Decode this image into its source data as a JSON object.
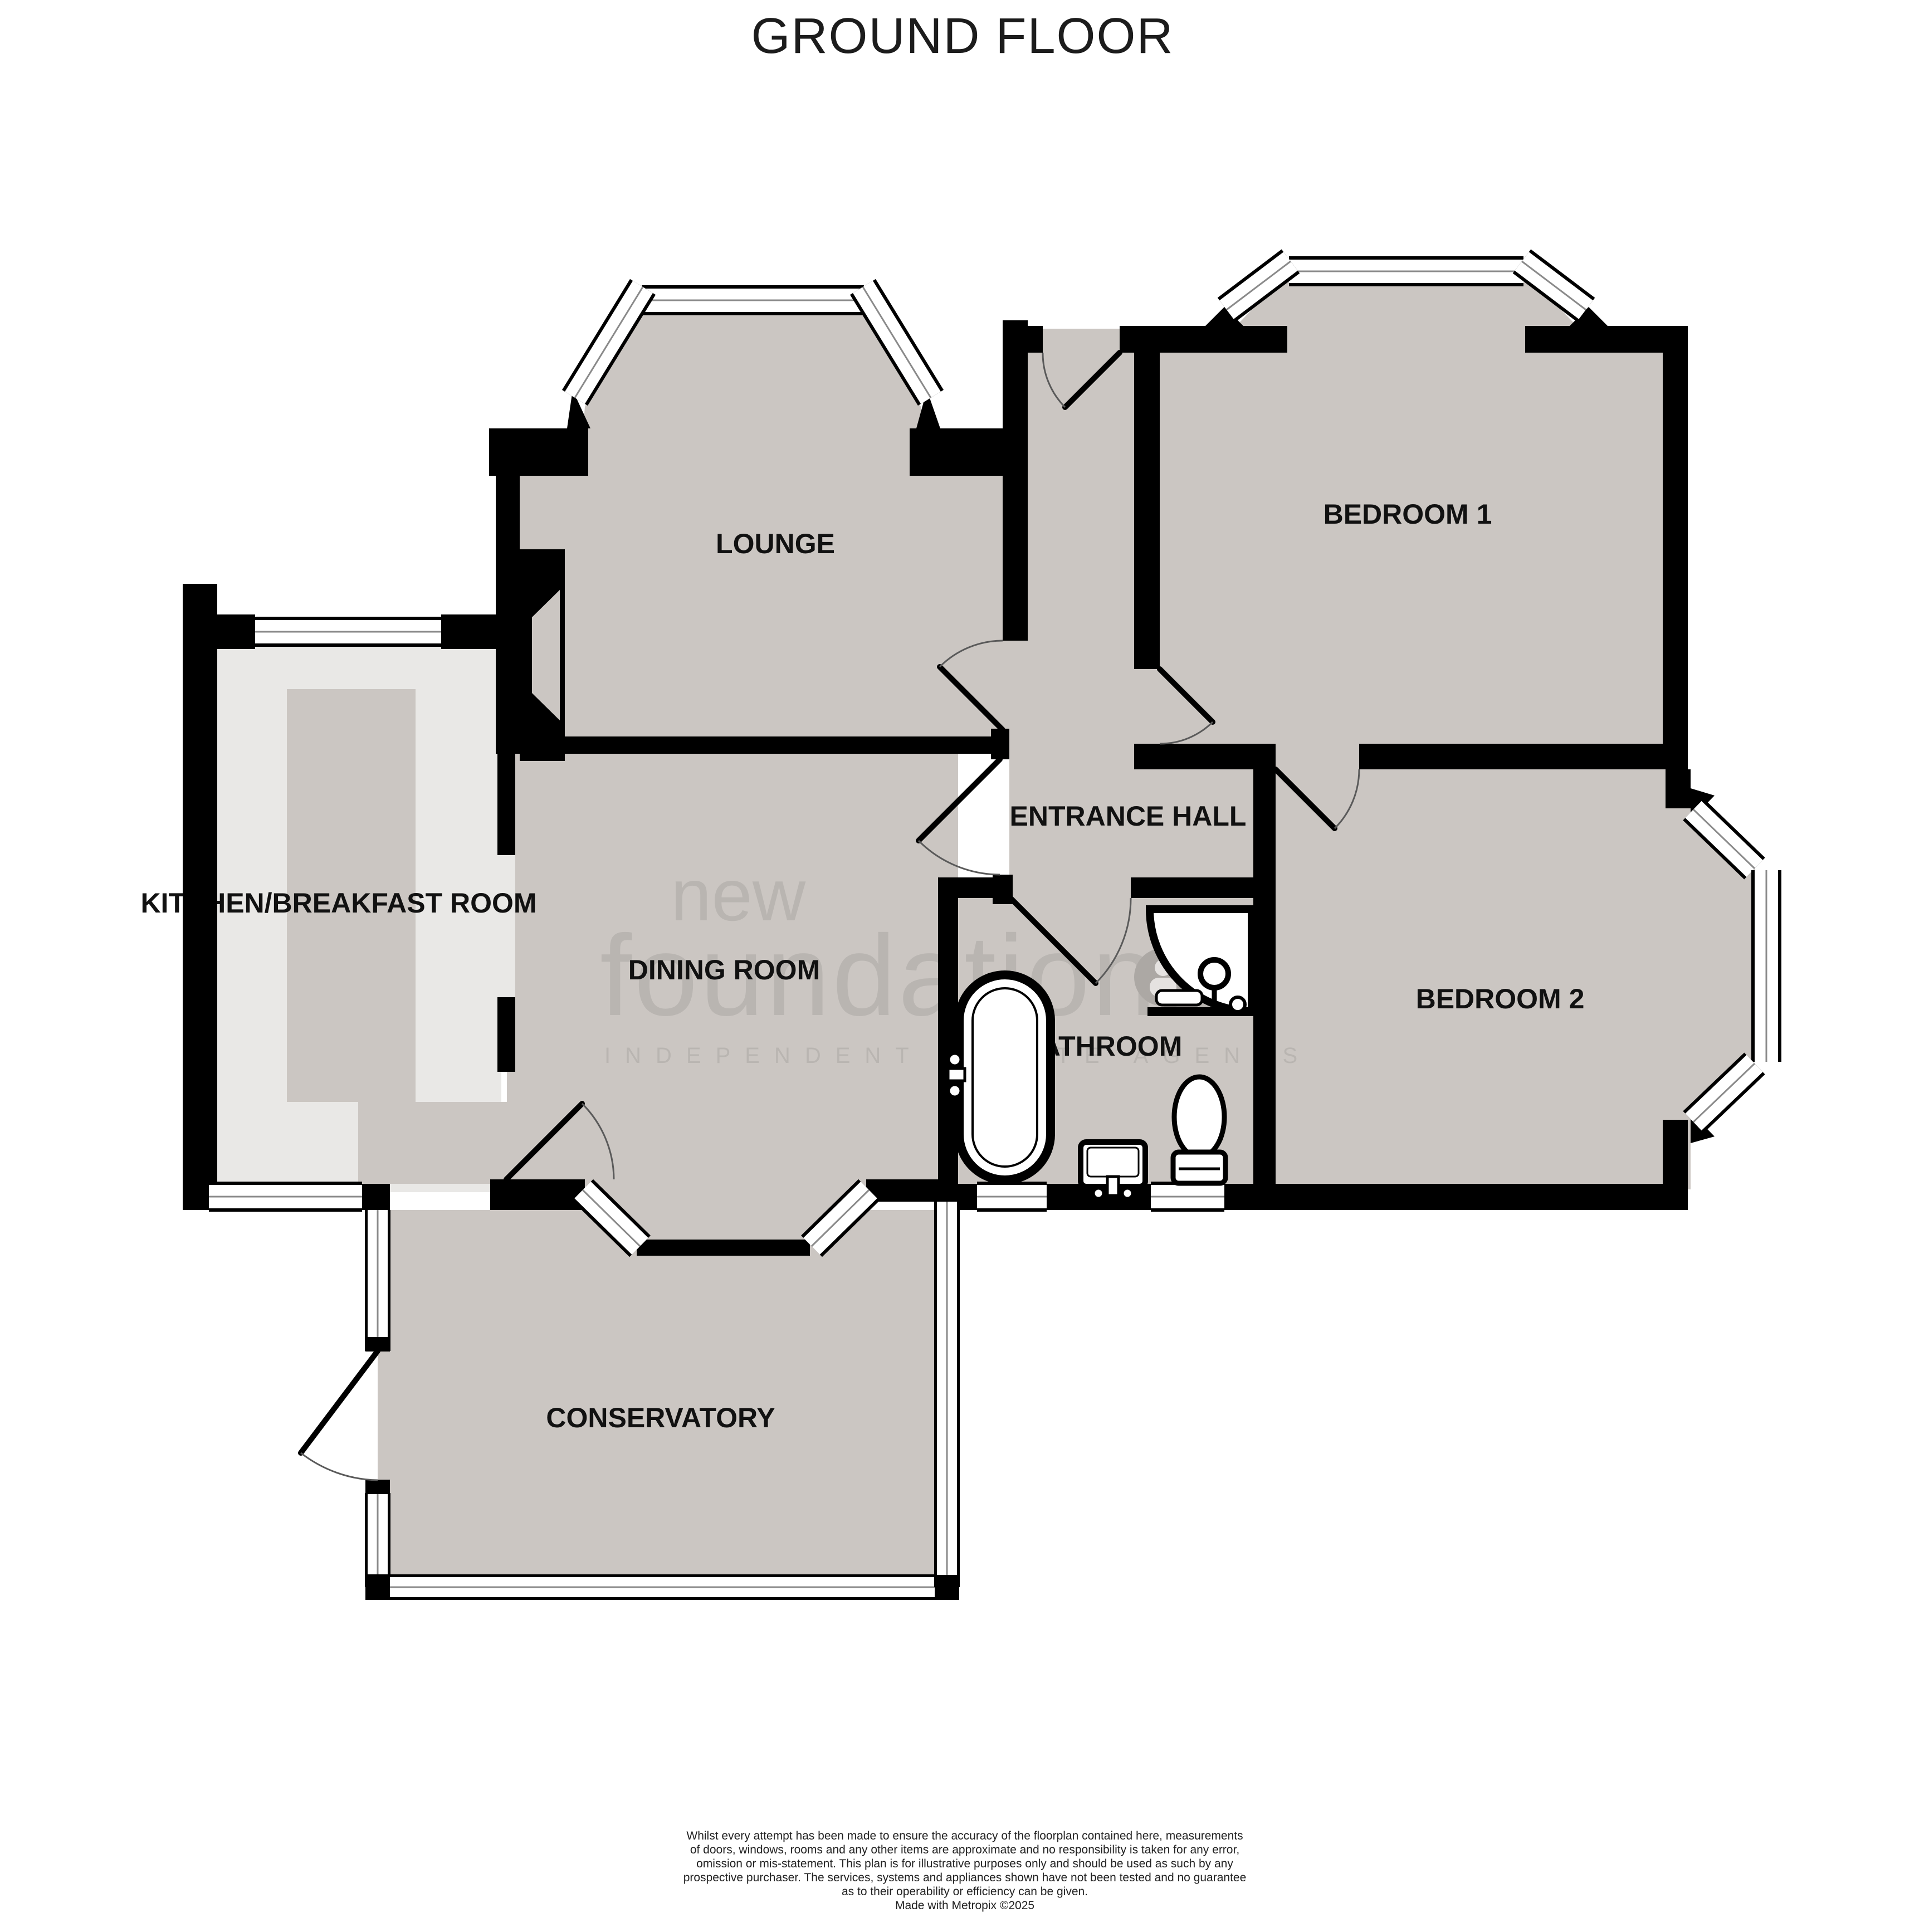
{
  "title": "GROUND FLOOR",
  "rooms": [
    {
      "label": "LOUNGE"
    },
    {
      "label": "BEDROOM 1"
    },
    {
      "label": "ENTRANCE HALL"
    },
    {
      "label": "KITCHEN/BREAKFAST ROOM"
    },
    {
      "label": "DINING ROOM"
    },
    {
      "label": "BATHROOM"
    },
    {
      "label": "BEDROOM 2"
    },
    {
      "label": "CONSERVATORY"
    }
  ],
  "watermark": {
    "word1": "new",
    "word2": "foundations",
    "tagline": "INDEPENDENT ESTATE AGENTS"
  },
  "fixtures": [
    {
      "name": "bathtub"
    },
    {
      "name": "corner-shower"
    },
    {
      "name": "sink"
    },
    {
      "name": "toilet"
    }
  ],
  "footer": {
    "lines": [
      "Whilst every attempt has been made to ensure the accuracy of the floorplan contained here, measurements",
      "of doors, windows, rooms and any other items are approximate and no responsibility is taken for any error,",
      "omission or mis-statement. This plan is for illustrative purposes only and should be used as such by any",
      "prospective purchaser. The services, systems and appliances shown have not been tested and no guarantee",
      "as to their operability or efficiency can be given."
    ],
    "credit": "Made with Metropix ©2025"
  },
  "colors": {
    "floor": "#cbc6c2",
    "kitchen_floor": "#e9e8e6",
    "wall": "#000000",
    "window_frame": "#8a8a8a",
    "watermark": "#a9a5a2"
  }
}
